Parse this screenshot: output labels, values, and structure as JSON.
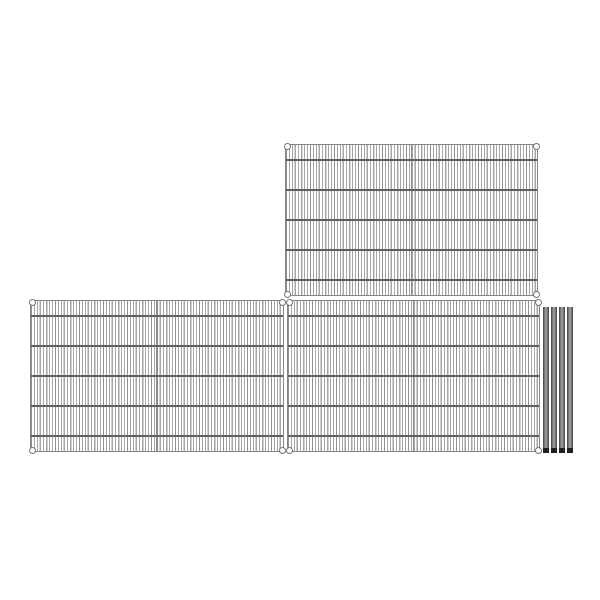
{
  "image": {
    "type": "product-image",
    "description": "Wire shelving kit shown on a plain white background: three rectangular chrome wire mesh shelf panels (one at top right, two side by side below) each with four corner mounting collars and five horizontal support wires, plus four gray metal shelving posts standing at the right edge",
    "background_color": "#ffffff"
  },
  "components": {
    "shelves": [
      {
        "id": "top",
        "position": "top-right",
        "corner_collars": 4,
        "cross_wires": 5
      },
      {
        "id": "bottom-left",
        "position": "bottom-left",
        "corner_collars": 4,
        "cross_wires": 5
      },
      {
        "id": "bottom-right",
        "position": "bottom-right",
        "corner_collars": 4,
        "cross_wires": 5
      }
    ],
    "posts": {
      "count": 4,
      "position": "right-of-bottom-right-shelf",
      "has_dark_foot_tip": true
    }
  },
  "colors": {
    "background": "#ffffff",
    "wire": "#a6a6a6",
    "frame": "#858585",
    "cross_wire": "#5f5f5f",
    "center_seam": "#8d8d8d",
    "collar_stroke": "#757575",
    "collar_fill": "#ffffff",
    "post_edge": "#3d3d3d",
    "post_center": "#9a9a9a",
    "post_foot": "#1f1f1f"
  }
}
